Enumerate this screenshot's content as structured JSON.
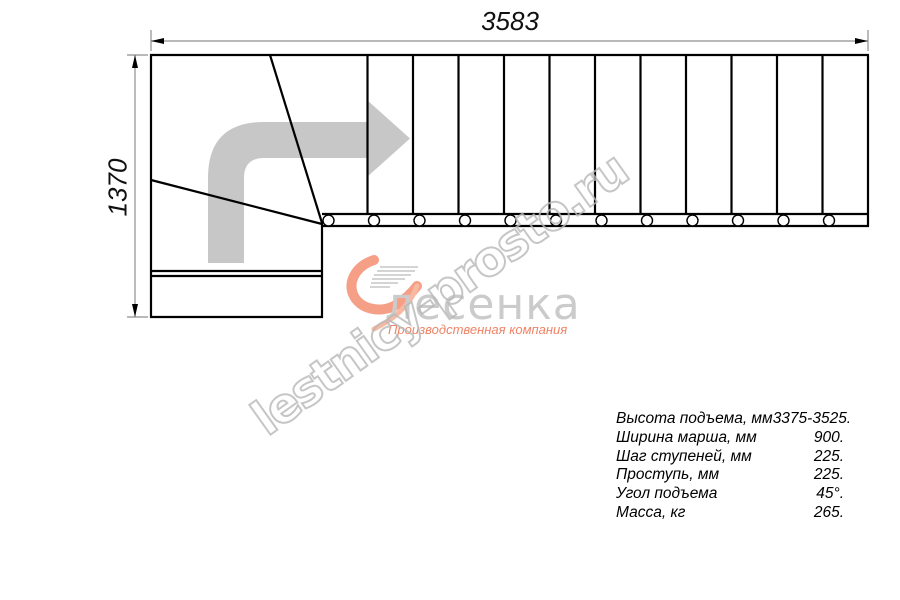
{
  "drawing": {
    "dimensions": {
      "width_label": "3583",
      "height_label": "1370"
    },
    "treads_count": 12,
    "colors": {
      "outline": "#000000",
      "dimension_line": "#8f8f8f",
      "direction_arrow_fill": "#c7c7c7"
    }
  },
  "logo": {
    "name": "лесенка",
    "tagline": "Производственная компания",
    "accent_color": "#f0876d",
    "name_color": "#cbcbcb"
  },
  "watermark": {
    "text": "lestnicy-prosto.ru"
  },
  "specs": {
    "rows": [
      {
        "label": "Высота подъема, мм",
        "value": "3375-3525."
      },
      {
        "label": "Ширина марша, мм",
        "value": "900."
      },
      {
        "label": "Шаг ступеней, мм",
        "value": "225."
      },
      {
        "label": "Проступь, мм",
        "value": "225."
      },
      {
        "label": "Угол подъема",
        "value": "45°."
      },
      {
        "label": "Масса, кг",
        "value": "265."
      }
    ]
  }
}
